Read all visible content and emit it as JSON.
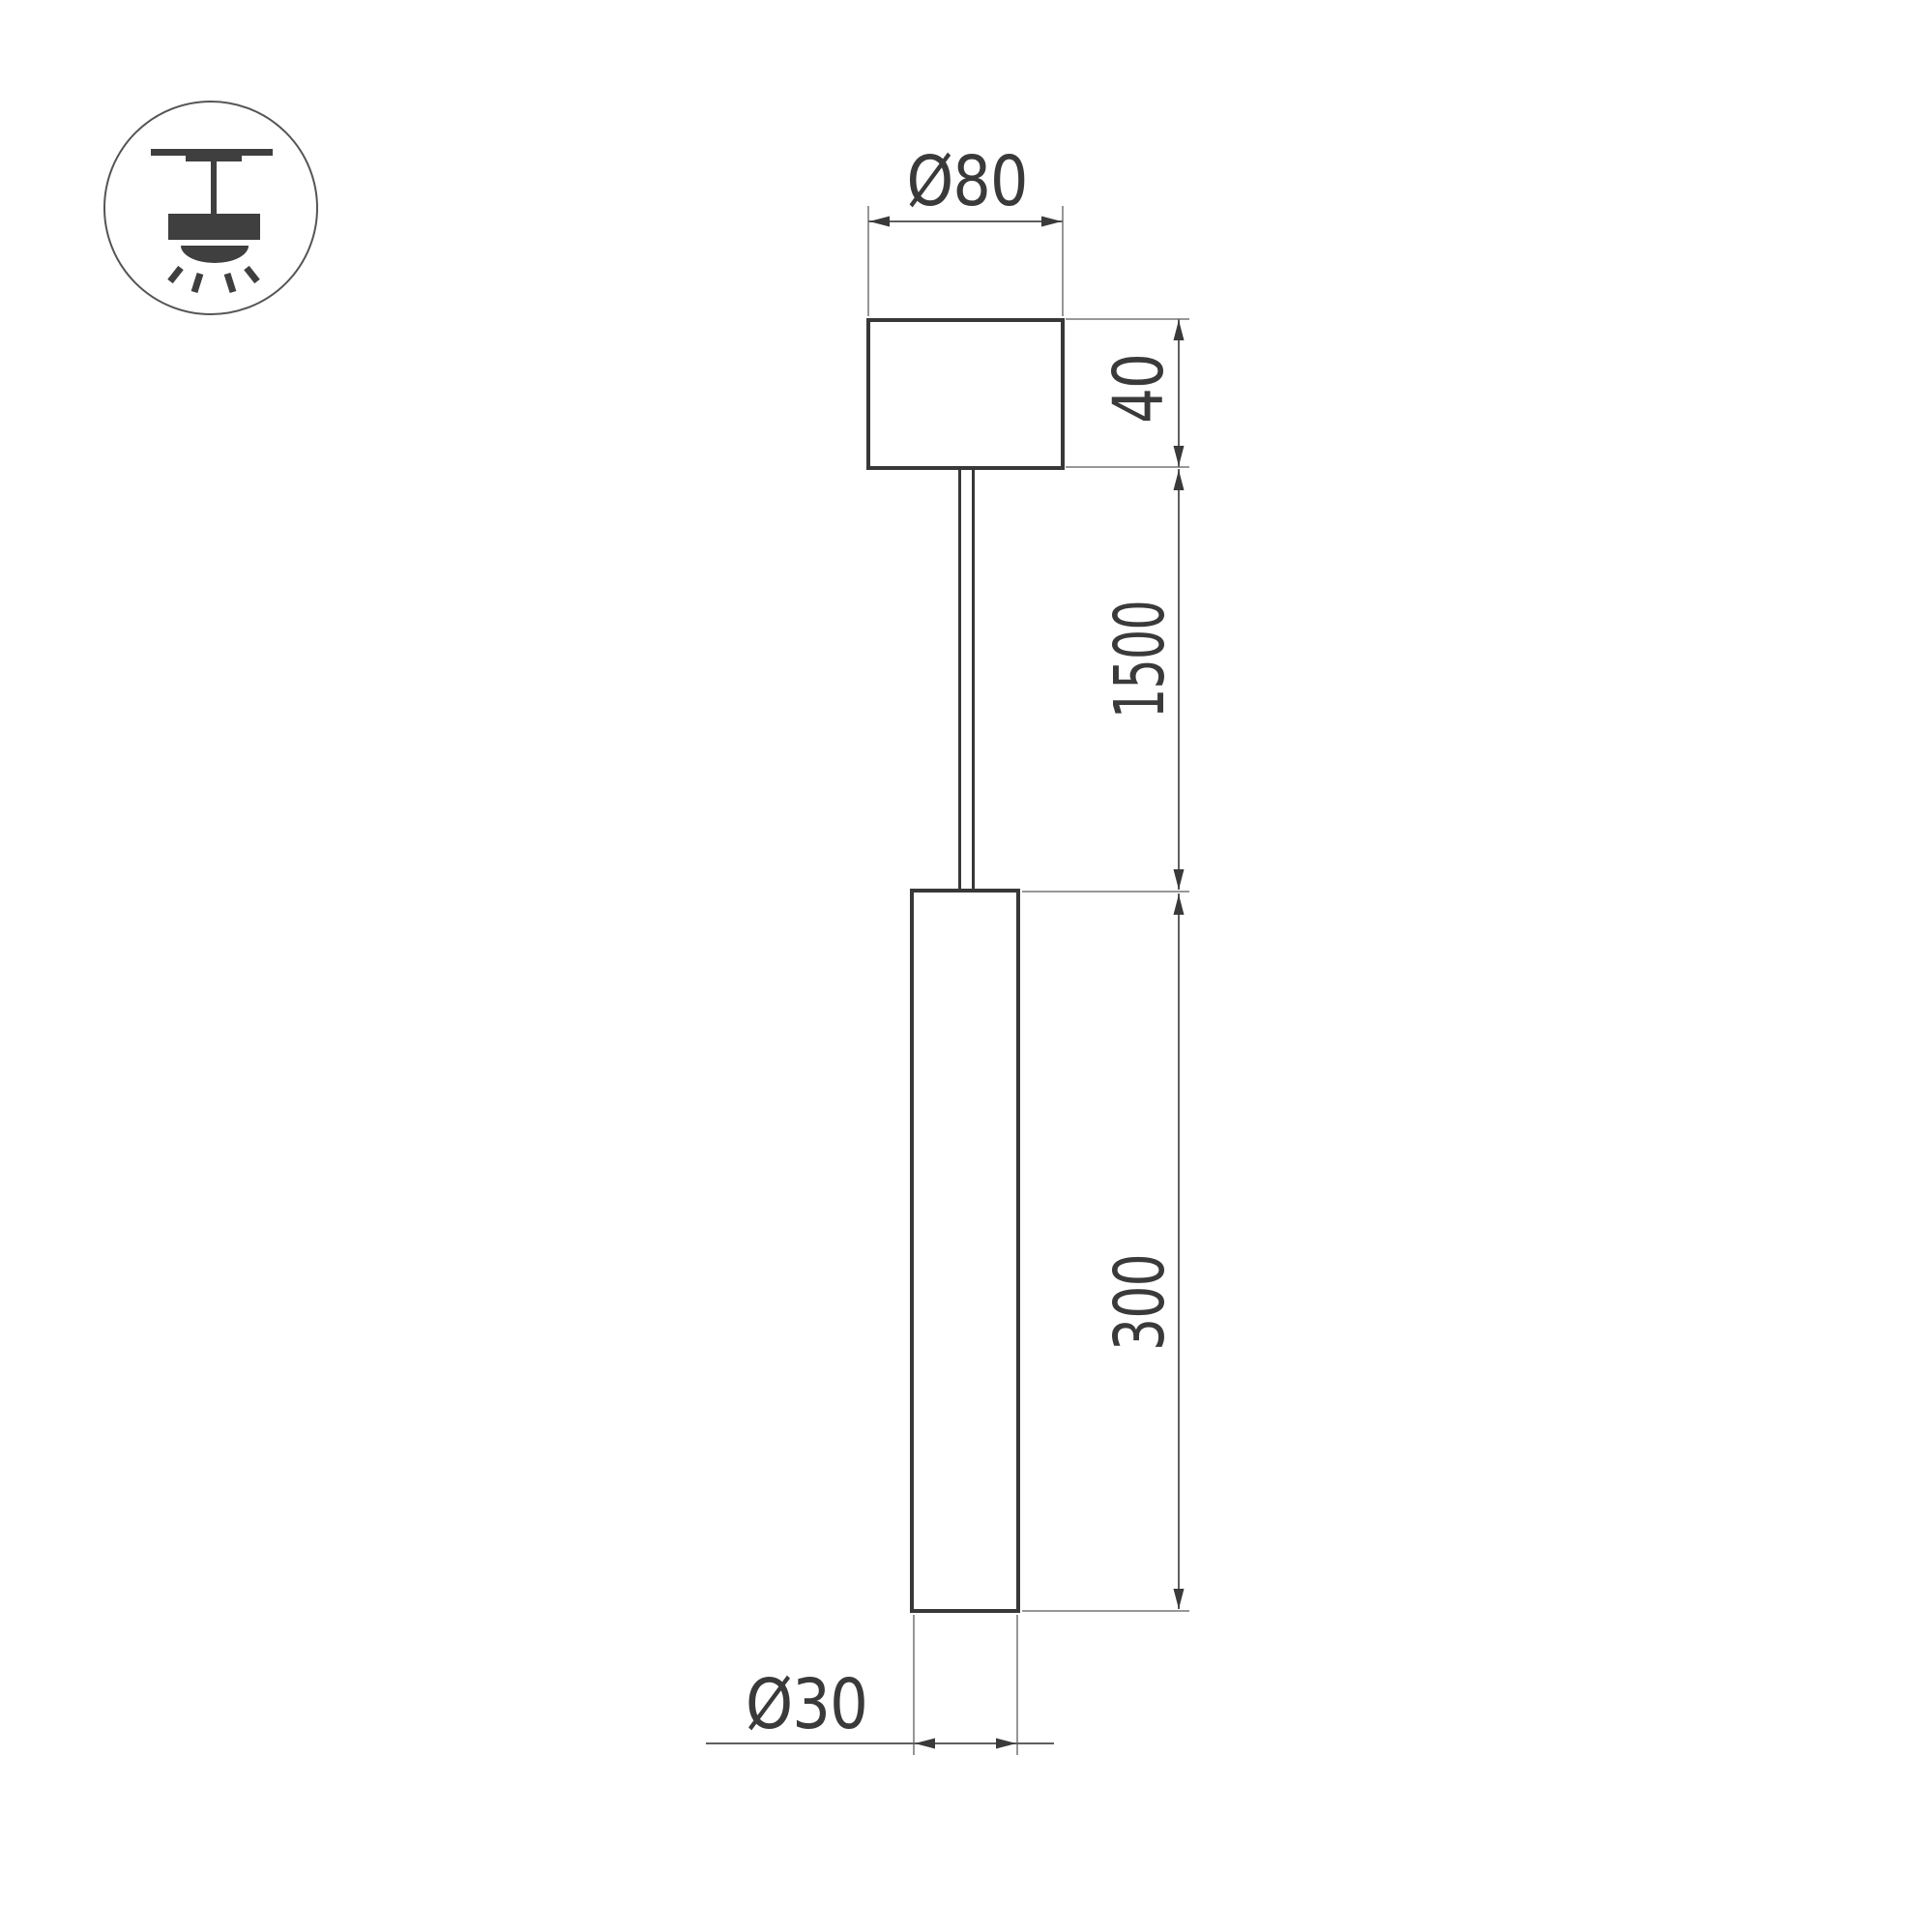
{
  "drawing": {
    "title": "pendant-luminaire-dimension-drawing",
    "labels": {
      "canopy_diameter": "Ø80",
      "canopy_height": "40",
      "suspension_length": "1500",
      "tube_length": "300",
      "tube_diameter": "Ø30"
    },
    "icon": "pendant-ceiling-light-icon"
  },
  "colors": {
    "background": "#ffffff",
    "object_line": "#383838",
    "dimension_line": "#5f5f5f",
    "extension_line": "#8a8a8a",
    "arrow": "#3a3a3a",
    "text": "#3a3a3a",
    "icon_fill": "#3f3f3f",
    "icon_outline": "#555555"
  }
}
